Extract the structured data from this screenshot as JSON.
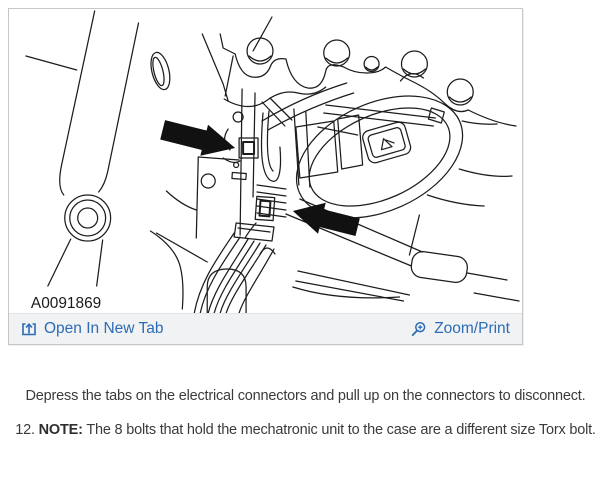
{
  "figure": {
    "image_label": "A0091869",
    "toolbar": {
      "open_in_new_tab_label": "Open In New Tab",
      "zoom_print_label": "Zoom/Print"
    }
  },
  "instructions": {
    "depress_line": "Depress the tabs on the electrical connectors and pull up on the connectors to disconnect.",
    "step": {
      "number": "12.",
      "note_label": "NOTE:",
      "text": "The 8 bolts that hold the mechatronic unit to the case are a different size Torx bolt."
    }
  },
  "diagram": {
    "description": "Line drawing of transmission case with mechatronic unit; two black arrows point to the electrical connectors",
    "callout_arrows": 2
  },
  "colors": {
    "link": "#2c6cb4",
    "toolbar_bg": "#f1f2f4",
    "card_border": "#c6c6c6",
    "body_text": "#3b3b3b",
    "diagram_ink": "#1c1c1c",
    "arrow_fill": "#111111"
  }
}
